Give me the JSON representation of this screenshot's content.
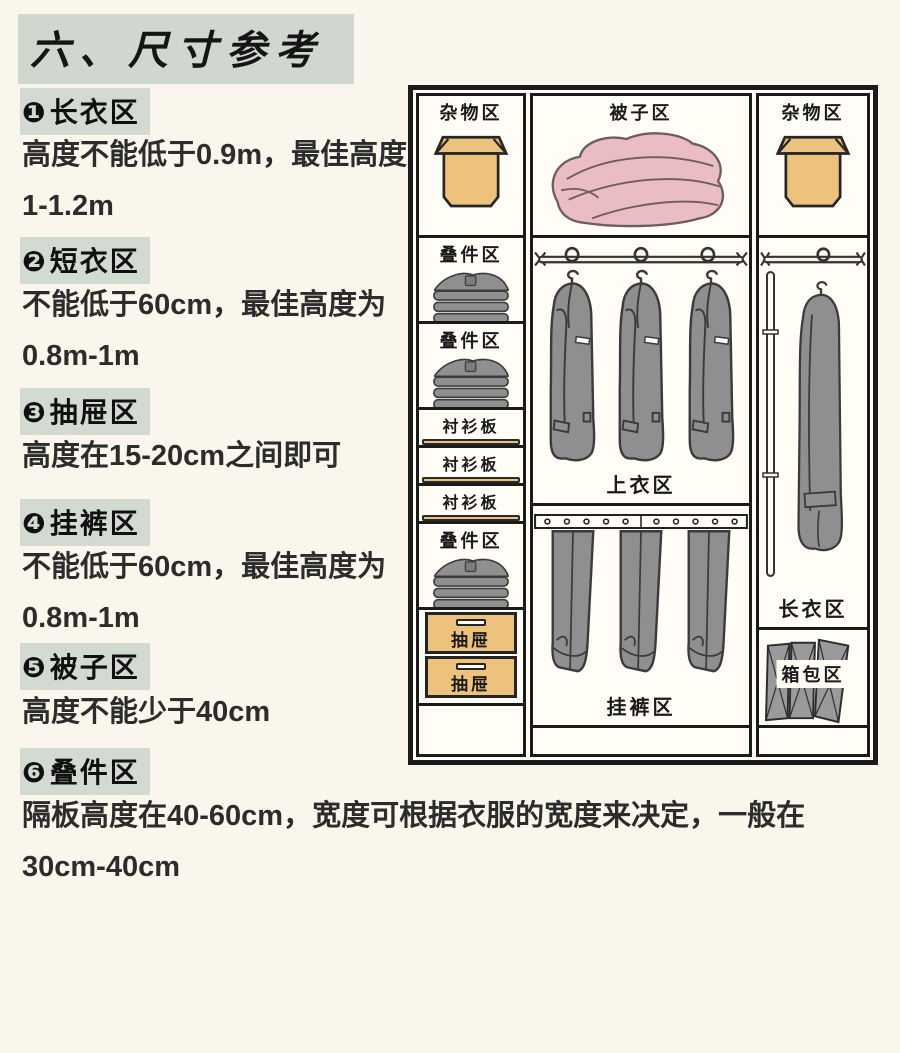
{
  "page": {
    "title": "六、尺寸参考"
  },
  "notes": [
    {
      "num": "❶",
      "title": "长衣区",
      "body": "高度不能低于0.9m，最佳高度1-1.2m"
    },
    {
      "num": "❷",
      "title": "短衣区",
      "body": "不能低于60cm，最佳高度为0.8m-1m"
    },
    {
      "num": "❸",
      "title": "抽屉区",
      "body": "高度在15-20cm之间即可"
    },
    {
      "num": "❹",
      "title": "挂裤区",
      "body": "不能低于60cm，最佳高度为0.8m-1m"
    },
    {
      "num": "❺",
      "title": "被子区",
      "body": "高度不能少于40cm"
    },
    {
      "num": "❻",
      "title": "叠件区",
      "body": "隔板高度在40-60cm，宽度可根据衣服的宽度来决定，一般在30cm-40cm"
    }
  ],
  "wardrobe": {
    "left_misc": "杂物区",
    "left_fold1": "叠件区",
    "left_fold2": "叠件区",
    "board1": "衬衫板",
    "board2": "衬衫板",
    "board3": "衬衫板",
    "left_fold3": "叠件区",
    "drawer1": "抽屉",
    "drawer2": "抽屉",
    "quilt": "被子区",
    "tops": "上衣区",
    "pants": "挂裤区",
    "right_misc": "杂物区",
    "long_coat": "长衣区",
    "bags": "箱包区"
  },
  "colors": {
    "highlight_green": "#d3dad2",
    "wood_tan": "#edc27c",
    "quilt_pink": "#e9bdc1",
    "garment_gray": "#8f8f8f",
    "frame_black": "#1b1b1b",
    "background_cream": "#faf6ec"
  }
}
